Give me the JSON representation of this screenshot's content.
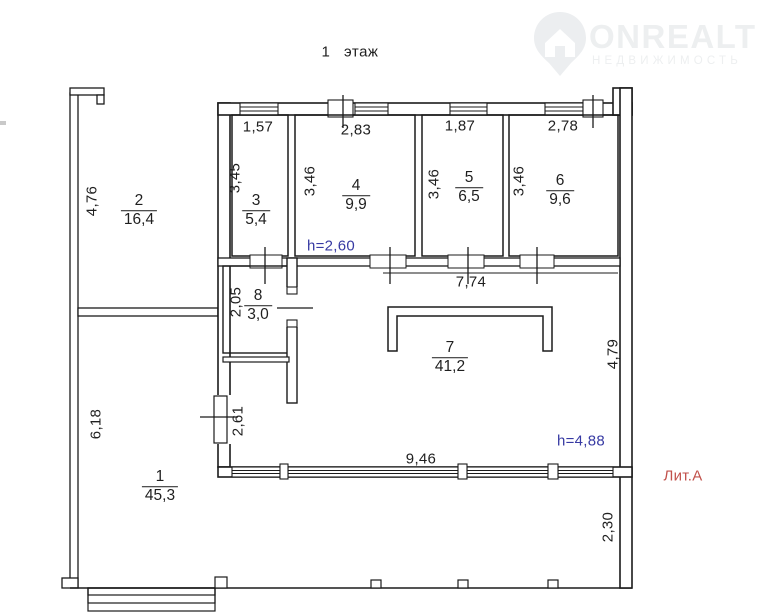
{
  "title": "1 этаж",
  "watermark": {
    "brand": "ONREALT",
    "subtitle": "НЕДВИЖИМОСТЬ"
  },
  "annotations": {
    "litera": "Лит.А",
    "height_room4": "h=2,60",
    "height_hall": "h=4,88"
  },
  "colors": {
    "blue": "#373aa3",
    "red": "#c1514b",
    "line": "#1b1b1b",
    "wm": "#edeff0"
  },
  "rooms": [
    {
      "num": "1",
      "area": "45,3"
    },
    {
      "num": "2",
      "area": "16,4"
    },
    {
      "num": "3",
      "area": "5,4"
    },
    {
      "num": "4",
      "area": "9,9"
    },
    {
      "num": "5",
      "area": "6,5"
    },
    {
      "num": "6",
      "area": "9,6"
    },
    {
      "num": "7",
      "area": "41,2"
    },
    {
      "num": "8",
      "area": "3,0"
    }
  ],
  "dimensions": {
    "room3_w": "1,57",
    "room4_w": "2,83",
    "room5_w": "1,87",
    "room6_w": "2,78",
    "room3_h": "3,45",
    "room4_h": "3,46",
    "room5_h": "3,46",
    "room6_h": "3,46",
    "room2_h": "4,76",
    "room8_h": "2,05",
    "opening_left": "2,61",
    "room1_h": "6,18",
    "corridor_w": "7,74",
    "hall_w": "9,46",
    "hall_h": "4,79",
    "terrace_h": "2,30"
  }
}
